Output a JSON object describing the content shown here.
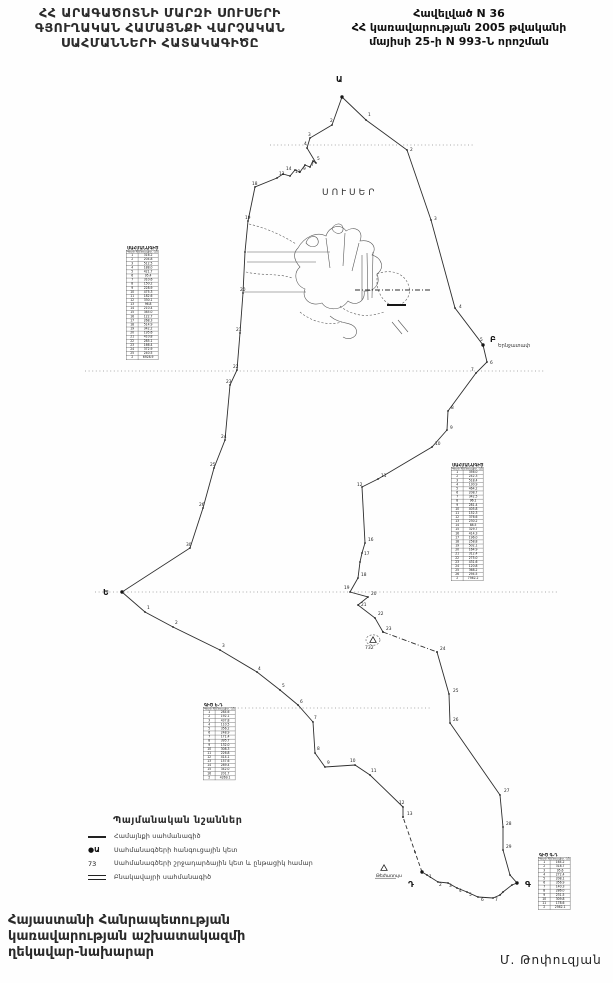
{
  "title_left": {
    "lines": [
      "ՀՀ ԱՐԱԳԱԾՈՏՆԻ ՄԱՐԶԻ ՍՈՒՍԵՐԻ",
      "ԳՅՈՒՂԱԿԱՆ ՀԱՄԱՅՆՔԻ ՎԱՐՉԱԿԱՆ",
      "ՍԱՀՄԱՆՆԵՐԻ ՀԱՏԱԿԱԳԻԾԸ"
    ]
  },
  "header_right": {
    "lines": [
      "Հավելված N 36",
      "ՀՀ կառավարության 2005 թվականի",
      "մայիսի 25-ի N 993-Ն որոշման"
    ]
  },
  "map": {
    "village": {
      "label": "ՍՈՒՍԵՐ",
      "x": 322,
      "y": 195
    },
    "neighbor": {
      "label": "Երնջատափ",
      "x": 498,
      "y": 347
    },
    "junctions": [
      {
        "x": 336,
        "y": 82,
        "label": "Ա"
      },
      {
        "x": 490,
        "y": 342,
        "label": "Բ"
      },
      {
        "x": 525,
        "y": 887,
        "label": "Գ"
      },
      {
        "x": 408,
        "y": 887,
        "label": "Դ"
      },
      {
        "x": 103,
        "y": 595,
        "label": "Ե"
      }
    ],
    "junction_dots": [
      [
        342,
        97
      ],
      [
        483,
        345
      ],
      [
        517,
        883
      ],
      [
        422,
        872
      ],
      [
        122,
        592
      ]
    ],
    "boundary_segments": [
      {
        "style": "solid",
        "pts": [
          [
            342,
            97
          ],
          [
            366,
            120
          ],
          [
            407,
            150
          ],
          [
            431,
            220
          ],
          [
            455,
            308
          ],
          [
            483,
            345
          ],
          [
            487,
            362
          ],
          [
            476,
            373
          ],
          [
            448,
            411
          ],
          [
            447,
            430
          ],
          [
            432,
            447
          ],
          [
            378,
            479
          ],
          [
            362,
            487
          ],
          [
            365,
            543
          ],
          [
            362,
            553
          ],
          [
            360,
            562
          ],
          [
            358,
            578
          ],
          [
            350,
            592
          ],
          [
            368,
            597
          ],
          [
            358,
            605
          ],
          [
            375,
            618
          ],
          [
            383,
            632
          ]
        ]
      },
      {
        "style": "dashdot",
        "pts": [
          [
            383,
            632
          ],
          [
            437,
            652
          ]
        ]
      },
      {
        "style": "solid",
        "pts": [
          [
            437,
            652
          ],
          [
            449,
            694
          ],
          [
            450,
            723
          ],
          [
            500,
            795
          ],
          [
            503,
            827
          ],
          [
            503,
            850
          ],
          [
            510,
            875
          ],
          [
            517,
            883
          ],
          [
            512,
            885
          ],
          [
            503,
            892
          ],
          [
            500,
            895
          ],
          [
            493,
            898
          ],
          [
            478,
            897
          ],
          [
            467,
            892
          ],
          [
            457,
            888
          ],
          [
            448,
            883
          ],
          [
            438,
            882
          ],
          [
            427,
            875
          ],
          [
            422,
            872
          ]
        ]
      },
      {
        "style": "dash",
        "pts": [
          [
            422,
            872
          ],
          [
            415,
            852
          ],
          [
            403,
            817
          ]
        ]
      },
      {
        "style": "solid",
        "pts": [
          [
            403,
            817
          ],
          [
            403,
            807
          ],
          [
            370,
            775
          ],
          [
            355,
            765
          ],
          [
            325,
            767
          ],
          [
            315,
            753
          ],
          [
            313,
            722
          ],
          [
            298,
            705
          ],
          [
            280,
            690
          ],
          [
            257,
            672
          ],
          [
            220,
            650
          ],
          [
            173,
            627
          ],
          [
            145,
            612
          ],
          [
            122,
            592
          ],
          [
            190,
            548
          ],
          [
            203,
            508
          ],
          [
            214,
            468
          ],
          [
            225,
            440
          ],
          [
            230,
            385
          ],
          [
            237,
            370
          ],
          [
            240,
            333
          ],
          [
            243,
            293
          ],
          [
            245,
            252
          ],
          [
            248,
            221
          ],
          [
            255,
            187
          ],
          [
            277,
            178
          ],
          [
            283,
            174
          ],
          [
            290,
            176
          ],
          [
            295,
            170
          ],
          [
            300,
            172
          ],
          [
            305,
            165
          ],
          [
            310,
            167
          ],
          [
            313,
            161
          ],
          [
            316,
            163
          ],
          [
            307,
            148
          ],
          [
            310,
            138
          ],
          [
            332,
            125
          ],
          [
            342,
            97
          ]
        ]
      }
    ],
    "point_numbers": [
      [
        368,
        116,
        "1"
      ],
      [
        410,
        151,
        "2"
      ],
      [
        434,
        220,
        "3"
      ],
      [
        459,
        308,
        "4"
      ],
      [
        480,
        341,
        "5"
      ],
      [
        490,
        364,
        "6"
      ],
      [
        471,
        371,
        "7"
      ],
      [
        451,
        409,
        "8"
      ],
      [
        450,
        429,
        "9"
      ],
      [
        435,
        445,
        "10"
      ],
      [
        381,
        477,
        "11"
      ],
      [
        357,
        486,
        "12"
      ],
      [
        368,
        541,
        "16"
      ],
      [
        364,
        555,
        "17"
      ],
      [
        361,
        576,
        "18"
      ],
      [
        344,
        589,
        "19"
      ],
      [
        371,
        595,
        "20"
      ],
      [
        361,
        606,
        "21"
      ],
      [
        378,
        615,
        "22"
      ],
      [
        386,
        630,
        "23"
      ],
      [
        440,
        650,
        "24"
      ],
      [
        453,
        692,
        "25"
      ],
      [
        453,
        721,
        "26"
      ],
      [
        504,
        792,
        "27"
      ],
      [
        506,
        825,
        "28"
      ],
      [
        506,
        848,
        "29"
      ],
      [
        429,
        878,
        "1"
      ],
      [
        439,
        886,
        "2"
      ],
      [
        449,
        887,
        "3"
      ],
      [
        459,
        892,
        "4"
      ],
      [
        469,
        896,
        "5"
      ],
      [
        481,
        901,
        "6"
      ],
      [
        495,
        901,
        "7"
      ],
      [
        147,
        609,
        "1"
      ],
      [
        175,
        624,
        "2"
      ],
      [
        222,
        647,
        "3"
      ],
      [
        258,
        670,
        "4"
      ],
      [
        282,
        687,
        "5"
      ],
      [
        300,
        703,
        "6"
      ],
      [
        314,
        719,
        "7"
      ],
      [
        317,
        750,
        "8"
      ],
      [
        327,
        764,
        "9"
      ],
      [
        350,
        762,
        "10"
      ],
      [
        371,
        772,
        "11"
      ],
      [
        399,
        804,
        "12"
      ],
      [
        407,
        815,
        "13"
      ],
      [
        330,
        122,
        "2"
      ],
      [
        308,
        136,
        "3"
      ],
      [
        304,
        145,
        "4"
      ],
      [
        317,
        160,
        "5"
      ],
      [
        311,
        166,
        "7"
      ],
      [
        303,
        170,
        "9"
      ],
      [
        295,
        173,
        "11"
      ],
      [
        279,
        175,
        "12"
      ],
      [
        286,
        170,
        "14"
      ],
      [
        252,
        185,
        "18"
      ],
      [
        245,
        219,
        "19"
      ],
      [
        240,
        291,
        "20"
      ],
      [
        236,
        331,
        "21"
      ],
      [
        233,
        368,
        "22"
      ],
      [
        226,
        383,
        "23"
      ],
      [
        221,
        438,
        "24"
      ],
      [
        210,
        466,
        "25"
      ],
      [
        199,
        506,
        "26"
      ],
      [
        186,
        546,
        "30"
      ]
    ],
    "scanlines": [
      {
        "x1": 270,
        "y": 145,
        "x2": 475
      },
      {
        "x1": 85,
        "y": 371,
        "x2": 545
      },
      {
        "x1": 95,
        "y": 592,
        "x2": 558
      },
      {
        "x1": 227,
        "y": 708,
        "x2": 430
      }
    ],
    "settlement_paths": [
      {
        "style": "normal",
        "d": "M298,248 C304,237 317,231 326,236 C329,226 341,223 346,231 C355,225 364,231 360,241 C371,239 378,247 372,255 C382,258 385,268 377,274 C381,284 374,292 364,291 C366,301 356,307 348,301 C341,311 327,311 322,303 C311,307 301,299 305,289 C295,285 293,273 300,267 C293,259 293,253 298,248 Z"
      },
      {
        "style": "dash",
        "d": "M377,274 C392,268 406,274 409,287 C412,299 400,309 389,304 C382,300 378,292 377,284 Z"
      },
      {
        "style": "normal",
        "d": "M326,238 L330,268 M345,233 L343,266 M359,243 L352,271"
      },
      {
        "style": "normal",
        "d": "M362,255 L362,300 M367,253 L368,300 M373,252 L372,298"
      },
      {
        "style": "normal",
        "d": "M247,252 L330,252 M247,262 L316,262 M244,292 L306,292"
      },
      {
        "style": "dashdot",
        "d": "M355,290 L432,290"
      },
      {
        "style": "bold",
        "d": "M387,305 L406,305"
      },
      {
        "style": "dash",
        "d": "M249,224 C266,228 282,235 296,244 M246,272 C262,276 278,273 292,278"
      },
      {
        "style": "normal",
        "d": "M306,243 C308,236 316,234 318,240 C320,246 312,250 306,243 Z M332,229 C334,223 342,222 343,228 C344,234 336,236 332,229 Z"
      },
      {
        "style": "dash",
        "d": "M340,306 C352,316 368,318 384,312 M300,312 C312,322 328,326 342,322"
      },
      {
        "style": "normal",
        "d": "M330,316 C340,325 352,321 356,329 C359,337 349,341 343,337"
      },
      {
        "style": "normal",
        "d": "M392,322 L402,334 M398,320 L408,332"
      }
    ],
    "triangles": [
      {
        "x": 373,
        "y": 640,
        "label": "732",
        "circled": true,
        "underlined": false
      },
      {
        "x": 384,
        "y": 868,
        "label": "Թեժառույս",
        "circled": false,
        "underlined": true
      }
    ]
  },
  "tables": [
    {
      "title": "ՍԱՀՄԱՆԱԳԻԾ",
      "x": 126,
      "y": 250,
      "w": 32,
      "h": 119,
      "cols": [
        "Կետի N",
        "Հեռավոր. (մ)"
      ],
      "rows": [
        [
          "1",
          "316.2"
        ],
        [
          "2",
          "204.8"
        ],
        [
          "3",
          "512.5"
        ],
        [
          "4",
          "188.0"
        ],
        [
          "5",
          "421.7"
        ],
        [
          "6",
          "95.4"
        ],
        [
          "7",
          "310.6"
        ],
        [
          "8",
          "150.2"
        ],
        [
          "9",
          "228.9"
        ],
        [
          "10",
          "475.3"
        ],
        [
          "11",
          "182.6"
        ],
        [
          "12",
          "330.1"
        ],
        [
          "13",
          "96.8"
        ],
        [
          "14",
          "210.4"
        ],
        [
          "15",
          "385.0"
        ],
        [
          "16",
          "122.7"
        ],
        [
          "17",
          "268.3"
        ],
        [
          "18",
          "514.9"
        ],
        [
          "19",
          "342.2"
        ],
        [
          "20",
          "195.6"
        ],
        [
          "21",
          "410.8"
        ],
        [
          "22",
          "285.1"
        ],
        [
          "23",
          "166.4"
        ],
        [
          "24",
          "372.9"
        ],
        [
          "25",
          "240.5"
        ],
        [
          "Σ",
          "6928.9"
        ]
      ]
    },
    {
      "title": "ՍԱՀՄԱՆԱԳԻԾ",
      "x": 451,
      "y": 467,
      "w": 31,
      "h": 124,
      "cols": [
        "Կետի N",
        "Հեռավոր. (մ)"
      ],
      "rows": [
        [
          "1",
          "356.0"
        ],
        [
          "2",
          "242.3"
        ],
        [
          "3",
          "518.4"
        ],
        [
          "4",
          "130.9"
        ],
        [
          "5",
          "464.2"
        ],
        [
          "6",
          "208.7"
        ],
        [
          "7",
          "342.5"
        ],
        [
          "8",
          "96.1"
        ],
        [
          "9",
          "281.4"
        ],
        [
          "10",
          "405.8"
        ],
        [
          "11",
          "152.3"
        ],
        [
          "12",
          "376.6"
        ],
        [
          "13",
          "230.2"
        ],
        [
          "14",
          "88.5"
        ],
        [
          "15",
          "329.7"
        ],
        [
          "16",
          "414.3"
        ],
        [
          "17",
          "196.0"
        ],
        [
          "18",
          "258.8"
        ],
        [
          "19",
          "502.1"
        ],
        [
          "20",
          "164.9"
        ],
        [
          "21",
          "312.4"
        ],
        [
          "22",
          "275.0"
        ],
        [
          "23",
          "431.6"
        ],
        [
          "24",
          "120.8"
        ],
        [
          "25",
          "368.2"
        ],
        [
          "26",
          "294.5"
        ],
        [
          "Σ",
          "7562.2"
        ]
      ]
    },
    {
      "title": "ԳԻԾ Ե-Դ",
      "x": 203,
      "y": 707,
      "w": 27,
      "h": 80,
      "cols": [
        "Կետի N",
        "Հեռավոր. (մ)"
      ],
      "rows": [
        [
          "1",
          "284.6"
        ],
        [
          "2",
          "192.1"
        ],
        [
          "3",
          "437.8"
        ],
        [
          "4",
          "110.5"
        ],
        [
          "5",
          "356.2"
        ],
        [
          "6",
          "248.9"
        ],
        [
          "7",
          "171.4"
        ],
        [
          "8",
          "395.7"
        ],
        [
          "9",
          "132.0"
        ],
        [
          "10",
          "308.3"
        ],
        [
          "11",
          "226.8"
        ],
        [
          "12",
          "414.1"
        ],
        [
          "13",
          "157.6"
        ],
        [
          "14",
          "289.4"
        ],
        [
          "15",
          "342.0"
        ],
        [
          "16",
          "201.7"
        ],
        [
          "Σ",
          "4269.1"
        ]
      ]
    },
    {
      "title": "ԳԻԾ Գ-Դ",
      "x": 538,
      "y": 857,
      "w": 30,
      "h": 62,
      "cols": [
        "Կետի N",
        "Հեռավոր. (մ)"
      ],
      "rows": [
        [
          "1",
          "164.2"
        ],
        [
          "2",
          "318.7"
        ],
        [
          "3",
          "95.6"
        ],
        [
          "4",
          "272.4"
        ],
        [
          "5",
          "208.1"
        ],
        [
          "6",
          "356.9"
        ],
        [
          "7",
          "140.3"
        ],
        [
          "8",
          "286.0"
        ],
        [
          "9",
          "231.5"
        ],
        [
          "10",
          "309.8"
        ],
        [
          "11",
          "178.6"
        ],
        [
          "Σ",
          "2562.1"
        ]
      ]
    }
  ],
  "legend": {
    "title": "Պայմանական նշաններ",
    "items": [
      {
        "symbol": "line",
        "label": "Համայնքի սահմանագիծ"
      },
      {
        "symbol": "junction",
        "label": "Սահմանագծերի հանգուցային կետ"
      },
      {
        "symbol": "turnpoint",
        "label": "Սահմանագծերի շրջադարձային կետ և ընթացիկ համար"
      },
      {
        "symbol": "double",
        "label": "Բնակավայրի սահմանագիծ"
      }
    ],
    "junction_glyph": "●Ա",
    "turnpoint_glyph": "73"
  },
  "footer": {
    "left_lines": [
      "Հայաստանի Հանրապետության",
      "կառավարության աշխատակազմի",
      "ղեկավար-նախարար"
    ],
    "signature": "Մ. Թոփուզյան"
  }
}
